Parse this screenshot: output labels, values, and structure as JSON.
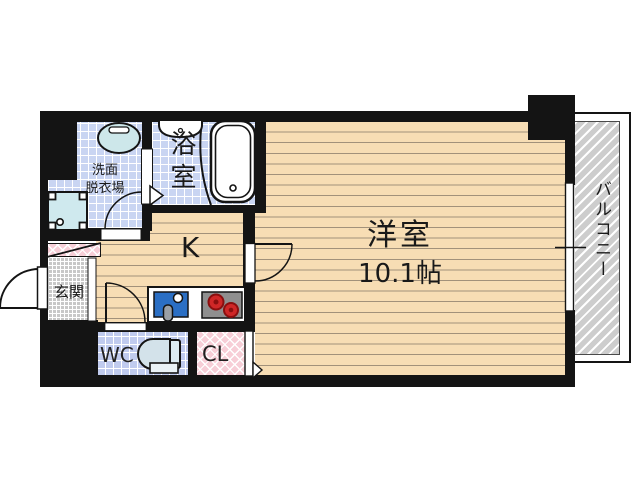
{
  "plan": {
    "rooms": {
      "living": {
        "label": "洋室",
        "size": "10.1帖"
      },
      "kitchen": {
        "label": "K"
      },
      "bathroom": {
        "label": "浴室"
      },
      "washroom": {
        "label_top": "洗面",
        "label_bottom": "脱衣場"
      },
      "entrance": {
        "label": "玄関"
      },
      "toilet": {
        "label": "WC"
      },
      "closet": {
        "label": "CL"
      },
      "balcony": {
        "label": "バルコニー"
      }
    },
    "fixtures": [
      "bathtub",
      "vanity-basin",
      "laundry-sink",
      "washing-machine-pan",
      "kitchen-counter",
      "kitchen-sink",
      "gas-stove",
      "toilet",
      "entrance-door",
      "folding-bath-door",
      "hinged-doors",
      "sliding-window",
      "closet-door"
    ],
    "colors": {
      "wall": "#141414",
      "wood_floor": "#f7ddb4",
      "tile_blue": "#c9d5f2",
      "tile_wc": "#c0cbee",
      "closet_pink": "#f7ced7",
      "balcony_gray": "#cdcdcd",
      "entrance_gray": "#c8c8c8",
      "sink_blue": "#2b6fc4",
      "stove_gray": "#8f8f8f",
      "burner_red": "#cf2727"
    }
  }
}
